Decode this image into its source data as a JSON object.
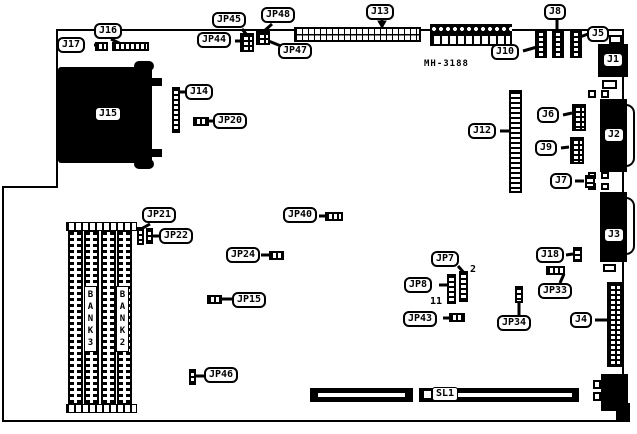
{
  "board": {
    "part_number": "MH-3188",
    "bank3": "BANK3",
    "bank2": "BANK2",
    "pin_annotations": {
      "jp7": "2",
      "jp8": "11"
    },
    "labels": {
      "J1": "J1",
      "J2": "J2",
      "J3": "J3",
      "J4": "J4",
      "J5": "J5",
      "J6": "J6",
      "J7": "J7",
      "J8": "J8",
      "J9": "J9",
      "J10": "J10",
      "J12": "J12",
      "J13": "J13",
      "J14": "J14",
      "J15": "J15",
      "J16": "J16",
      "J17": "J17",
      "J18": "J18",
      "JP7": "JP7",
      "JP8": "JP8",
      "JP15": "JP15",
      "JP20": "JP20",
      "JP21": "JP21",
      "JP22": "JP22",
      "JP24": "JP24",
      "JP33": "JP33",
      "JP34": "JP34",
      "JP40": "JP40",
      "JP43": "JP43",
      "JP44": "JP44",
      "JP45": "JP45",
      "JP46": "JP46",
      "JP47": "JP47",
      "JP48": "JP48",
      "SL1": "SL1"
    }
  }
}
